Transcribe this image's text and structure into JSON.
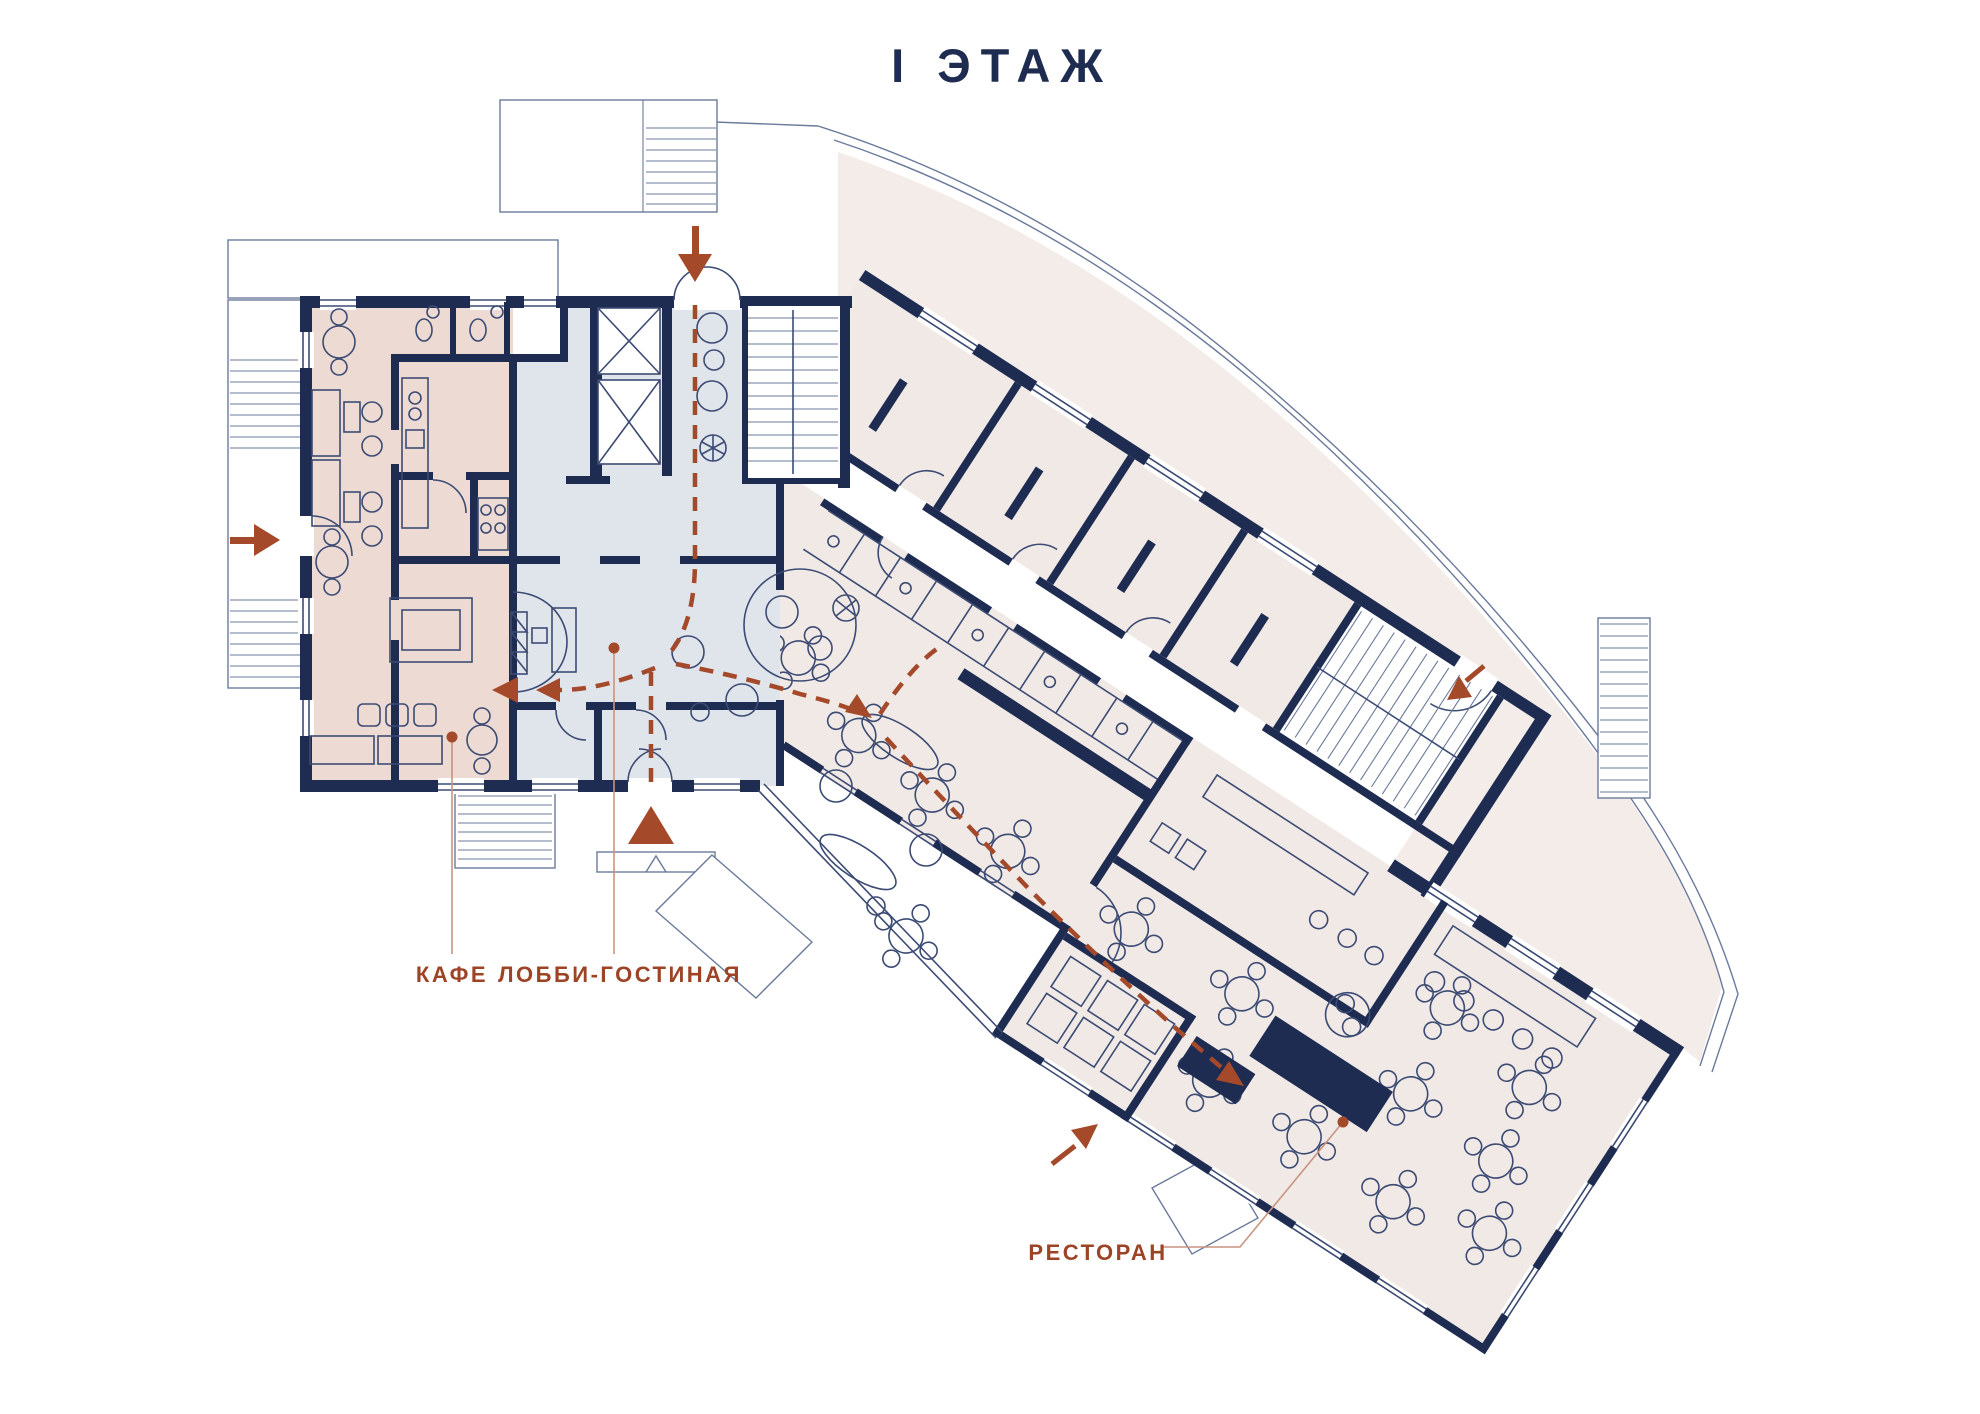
{
  "title": {
    "text": "I ЭТАЖ"
  },
  "labels": {
    "cafe": {
      "text": "КАФЕ"
    },
    "lobby": {
      "text": "ЛОББИ-ГОСТИНАЯ"
    },
    "restaurant": {
      "text": "РЕСТОРАН"
    }
  },
  "plan": {
    "floor_label": "I ЭТАЖ",
    "zones": [
      {
        "id": "cafe",
        "label": "КАФЕ",
        "fill_key": "cafe"
      },
      {
        "id": "lobby-lounge",
        "label": "ЛОББИ-ГОСТИНАЯ",
        "fill_key": "lobby"
      },
      {
        "id": "restaurant",
        "label": "РЕСТОРАН",
        "fill_key": "rooms"
      }
    ],
    "entrance_markers": [
      "top-entrance-arrow",
      "left-entrance-arrow",
      "side-entrance-arrow",
      "restaurant-entrance-arrow",
      "main-entrance-triangle"
    ]
  },
  "colors": {
    "paper": "#ffffff",
    "walls": "#1e2c52",
    "line": "#3c4b74",
    "site": "#6b7a9b",
    "cafe": "#ecdad3",
    "lobby": "#e0e4eb",
    "rooms": "#f1e9e5",
    "terrace": "#f3ece8",
    "accent": "#a4492a",
    "label": "#9c4425",
    "leader": "#c89480",
    "title": "#1d2c50"
  }
}
